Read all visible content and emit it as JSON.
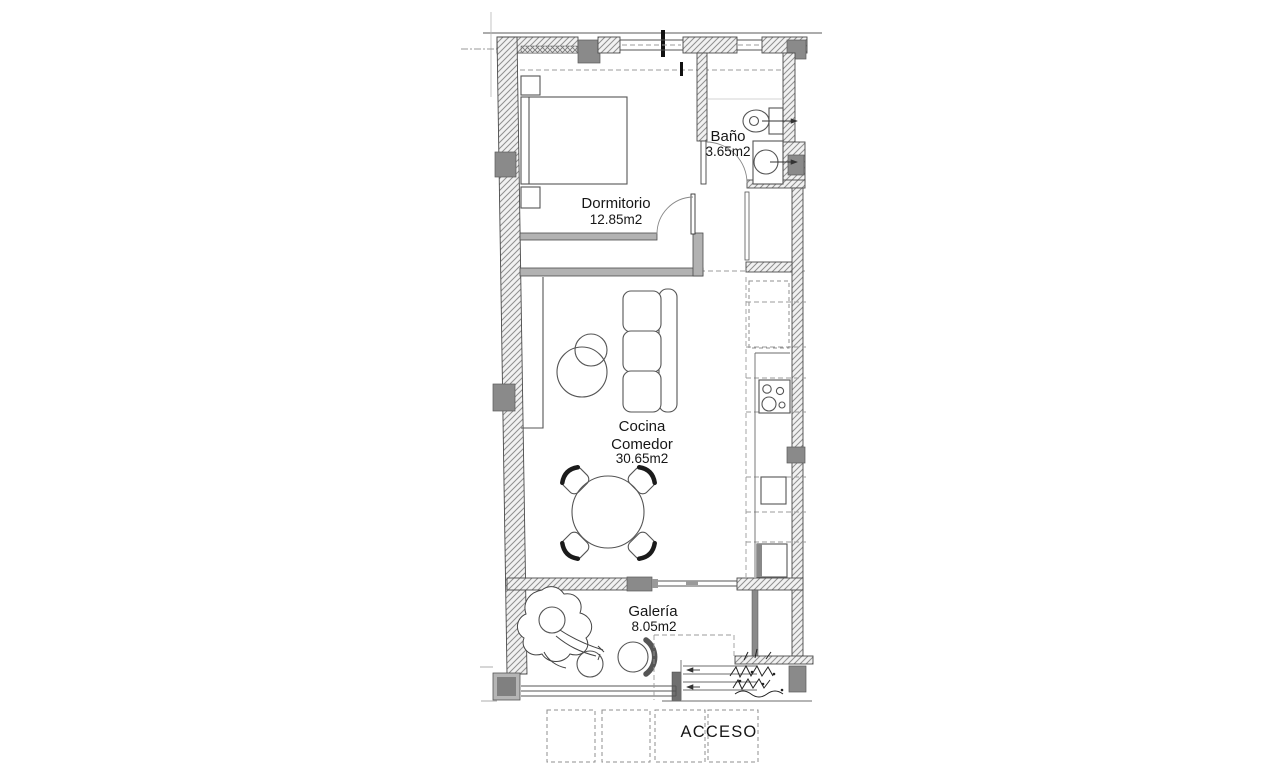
{
  "floorplan": {
    "rooms": {
      "dormitorio": {
        "name": "Dormitorio",
        "area": "12.85m2"
      },
      "bano": {
        "name": "Baño",
        "area": "3.65m2"
      },
      "cocina_comedor": {
        "name_line1": "Cocina",
        "name_line2": "Comedor",
        "area": "30.65m2"
      },
      "galeria": {
        "name": "Galería",
        "area": "8.05m2"
      }
    },
    "entrance_label": "ACCESO",
    "colors": {
      "background": "#ffffff",
      "wall_fill": "#f1f1f1",
      "wall_hatch": "#8f8f8f",
      "partition": "#b2b2b2",
      "pillar": "#8a8a8a",
      "outline": "#4b4b4b",
      "furniture_line": "#555555",
      "dashed_line": "#9b9b9b",
      "text": "#161616"
    }
  }
}
